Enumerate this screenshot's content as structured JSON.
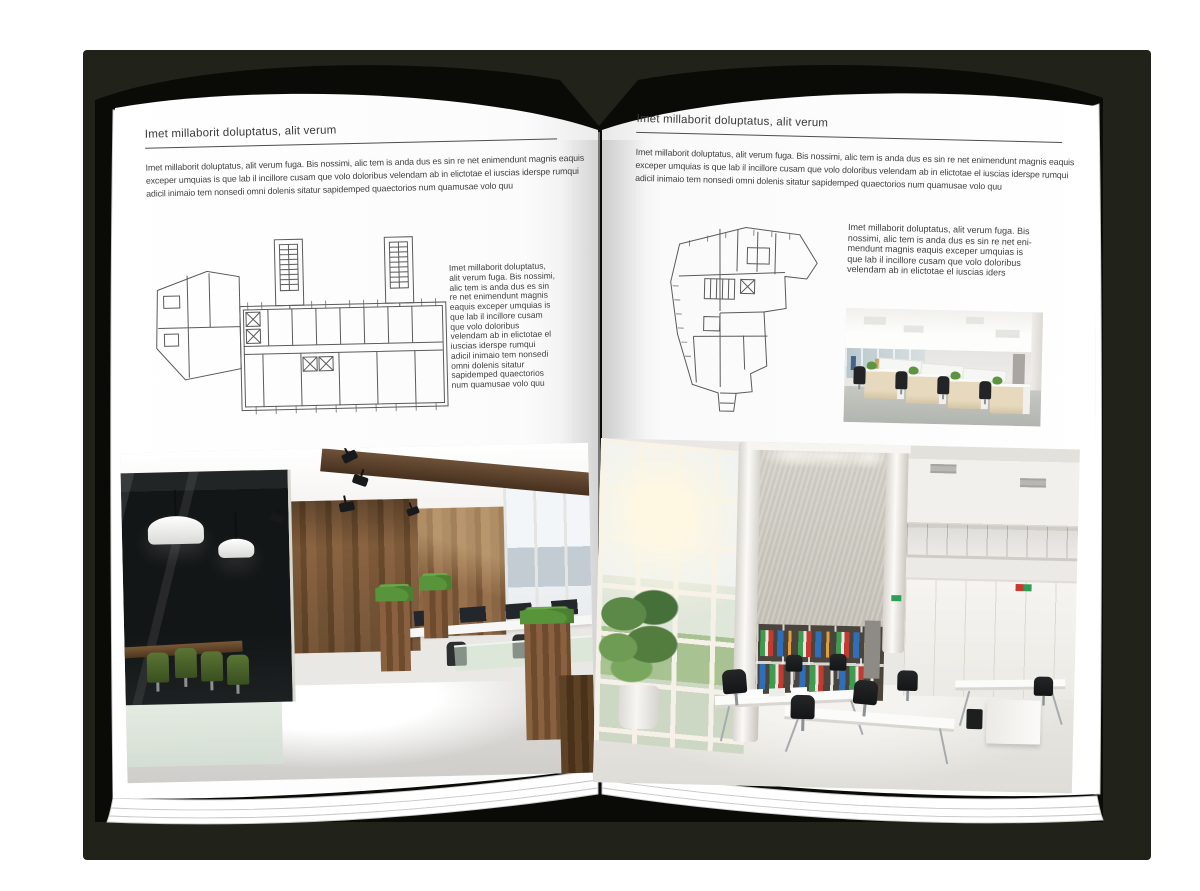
{
  "colors": {
    "backdrop": "#21231a",
    "cover": "#0a0b06",
    "page": "#ffffff",
    "ink": "#3d3d3d",
    "rule": "#4d4d4d",
    "plan": "#5a5a5a",
    "edge": "#c9c9c9"
  },
  "left_page": {
    "header": "Imet millaborit doluptatus, alit verum",
    "intro": "Imet millaborit doluptatus, alit verum fuga. Bis nossimi, alic tem is anda dus es sin re net enimendunt magnis eaquis exceper umquias is que lab il incillore cusam que volo doloribus velendam ab in elictotae el iuscias iderspe rumqui adicil inimaio tem nonsedi omni dolenis sitatur sapidemped quaectorios num quamusae volo quu",
    "side_text": "Imet millaborit doluptatus, alit verum fuga. Bis nossimi, alic tem is anda dus es sin re net enimendunt magnis eaquis exceper umquias is que lab il incillore cusam que volo doloribus velendam ab in elictotae el iuscias iderspe rumqui adicil inimaio tem nonsedi omni dolenis sitatur sapidemped quaectorios num quamusae volo quu",
    "floor_plan_alt": "architectural floor plan of an elongated building with two stair towers and an angled annex",
    "photo_alt": "loft office interior with dark glass meeting room, wood panel walls, desks and planters"
  },
  "right_page": {
    "header": "Imet millaborit doluptatus, alit verum",
    "intro": "Imet millaborit doluptatus, alit verum fuga. Bis nossimi, alic tem is anda dus es sin re net enimendunt magnis eaquis exceper umquias is que lab il incillore cusam que volo doloribus velendam ab in elictotae el iuscias iderspe rumqui adicil inimaio tem nonsedi omni dolenis sitatur sapidemped quaectorios num quamusae volo quu",
    "side_text": "Imet millaborit doluptatus, alit verum fuga. Bis nossimi, alic tem is anda dus es sin re net eni-mendunt magnis eaquis exceper umquias is que lab il incillore cusam que volo doloribus velendam ab in elictotae el iuscias iders",
    "floor_plan_alt": "architectural floor plan with an irregular curved footprint",
    "photo_small_alt": "open plan office with rows of light wood desk cabinets and black chairs",
    "photo_large_alt": "bright double-height office atrium with tall windows, concrete wall, bookshelves and white desks"
  }
}
